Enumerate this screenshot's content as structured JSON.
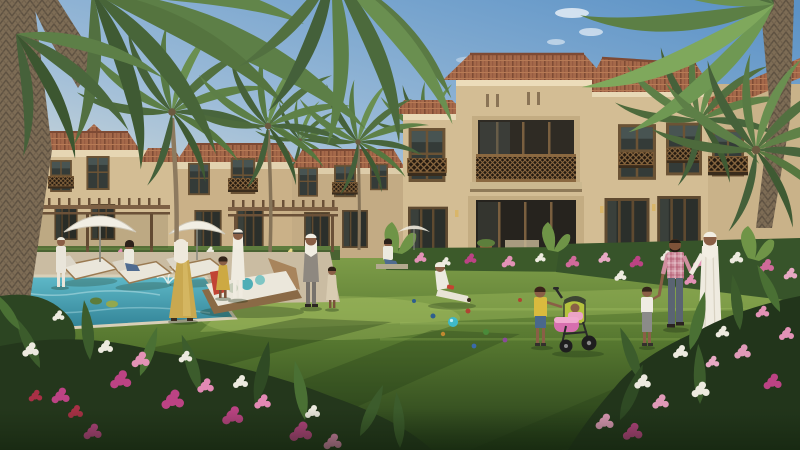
{
  "meta": {
    "description": "Photorealistic render of a beige Mediterranean-Arabic villa community: terracotta roofs, palm trees, swimming pool with white umbrellas and loungers, families in traditional and casual dress on a large green lawn, flower bushes in the foreground.",
    "width": 800,
    "height": 450
  },
  "palette": {
    "sky_top": "#5b92c6",
    "sky_mid": "#9dbcd8",
    "sky_horizon": "#e9e7d8",
    "wall": "#d3bd94",
    "wall_shadow": "#b49c74",
    "cornice": "#e8d9b6",
    "roof": "#a5694a",
    "roof_dark": "#7f4c35",
    "window_frame": "#6b5335",
    "glass": "#343b38",
    "lattice": "#8a6840",
    "lawn_light": "#7d9c48",
    "lawn_mid": "#55762f",
    "lawn_dark": "#263d1a",
    "hedge": "#3c5a2a",
    "deck": "#cabca2",
    "pool_light": "#5fb9c8",
    "pool_deep": "#2f7f93",
    "umbrella": "#f1eee4",
    "palm_light": "#7ba45a",
    "palm_dark": "#46613a",
    "trunk": "#7d6c55",
    "flower_magenta": "#bc4384",
    "flower_pink": "#e392b6",
    "flower_white": "#edeadf",
    "flower_red": "#a93046",
    "skin": "#8a5f46",
    "thobe_white": "#efebe0",
    "abaya_gold": "#c9a850",
    "plaid_pink": "#d08f9f",
    "boy_yellow": "#d9ba3e",
    "stroller_pink": "#d76fae",
    "ball_teal": "#3fb9c9"
  },
  "scene": {
    "buildings": {
      "left_villas": 3,
      "main_villa": "two-storey beige villa, central tower with mashrabiya balcony, terracotta hip roofs, glass doors on ground floor",
      "far_right_villa": "partially visible behind palm trunk"
    },
    "vegetation": {
      "giant_palms": 2,
      "mid_palms": 3,
      "distant_palm_canopies": 2,
      "flower_beds": "magenta, pink, white and red blooms in foreground corners and along villa fronts"
    },
    "pool_area": {
      "umbrellas": 4,
      "sun_loungers": 3,
      "daybed_pillows": "teal and sage, red towel",
      "fountain_jet": 1
    },
    "toys": {
      "play_balls": 9,
      "ball_colors": [
        "teal",
        "navy",
        "red",
        "green",
        "orange",
        "purple"
      ]
    }
  },
  "people": [
    {
      "id": "stander-left",
      "outfit": "white casual with cap",
      "x": 60,
      "y": 260
    },
    {
      "id": "seated-woman-lounger",
      "outfit": "white top, blue jeans",
      "x": 130,
      "y": 256
    },
    {
      "id": "seated-woman-2",
      "outfit": "white top, blue jeans",
      "x": 390,
      "y": 252
    },
    {
      "id": "woman-gold-abaya",
      "outfit": "gold abaya, white hijab",
      "x": 181,
      "y": 280
    },
    {
      "id": "girl-yellow-dress",
      "outfit": "gold dress",
      "x": 224,
      "y": 278
    },
    {
      "id": "man-white-thobe-center",
      "outfit": "white thobe and ghutra",
      "x": 239,
      "y": 262
    },
    {
      "id": "man-grey-ghutra",
      "outfit": "grey outfit, white ghutra",
      "x": 311,
      "y": 270
    },
    {
      "id": "boy-beige-thobe",
      "outfit": "beige thobe",
      "x": 333,
      "y": 286
    },
    {
      "id": "man-sitting-lawn",
      "outfit": "white, seated on grass",
      "x": 448,
      "y": 286
    },
    {
      "id": "boy-yellow-shirt",
      "outfit": "yellow tee, blue shorts, pushing stroller",
      "x": 540,
      "y": 316
    },
    {
      "id": "baby-in-stroller",
      "outfit": "pink blanket",
      "x": 574,
      "y": 310
    },
    {
      "id": "toddler-white-tee",
      "outfit": "white tee, grey pants",
      "x": 646,
      "y": 314
    },
    {
      "id": "man-pink-plaid",
      "outfit": "pink plaid shirt, grey jeans",
      "x": 675,
      "y": 290
    },
    {
      "id": "man-white-thobe-right",
      "outfit": "white thobe and ghutra",
      "x": 710,
      "y": 286
    }
  ]
}
